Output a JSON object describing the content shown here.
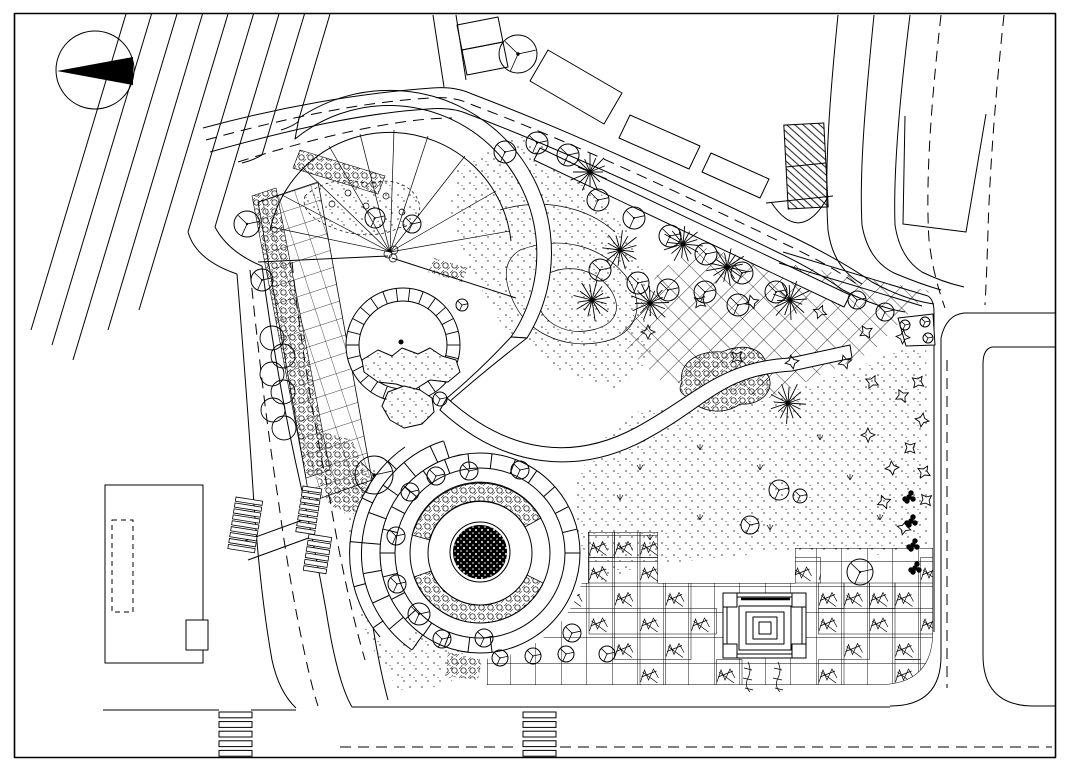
{
  "page": {
    "title": "Park landscape site plan - black and white CAD line drawing",
    "drawing_type": "landscape architecture plan view",
    "visible_text": "none"
  },
  "colors": {
    "background": "#ffffff",
    "ink": "#000000",
    "solid_fill": "#000000"
  },
  "labels": {
    "frame": "drawing frame border",
    "north_arrow": "north arrow compass with solid triangle",
    "roads": "perimeter roads with dashed center lines",
    "buildings": "surrounding buildings",
    "park": "park interior",
    "vegetation": "tree and shrub planting symbols",
    "fountain_plaza": "circular fountain plaza with concentric paved rings",
    "pond": "circular pond with segmented walk and rockery",
    "fan_plaza": "fan shaped entry plaza with radiating pavement joints",
    "grid_plaza": "square-grid paved plaza with planting cells",
    "pavilion": "square pavilion with concentric roof steps",
    "lawn": "stippled lawn and groundcover areas",
    "lattice": "diagonal lattice pavement area",
    "left_building": "building footprint west of park",
    "crosswalks": "zebra crosswalk markings",
    "stairs": "stepped entry flights on west road"
  },
  "feature_counts": {
    "deciduous_tree_symbols": 45,
    "palm_tree_symbols": 8,
    "spiky_shrub_symbols": 20,
    "hedge_circle_symbols": 6,
    "dark_bush_symbols": 4,
    "grass_tuft_marks": 10,
    "crosswalks": 2,
    "stair_flights": 3,
    "planting_cells_hatched": 28
  },
  "structures": {
    "pavilion_plan": "nested squares with four corner columns",
    "hatched_building": "diagonally hatched rectangular structure at north-east",
    "dome_structure": "semicircular element below hatched building"
  }
}
